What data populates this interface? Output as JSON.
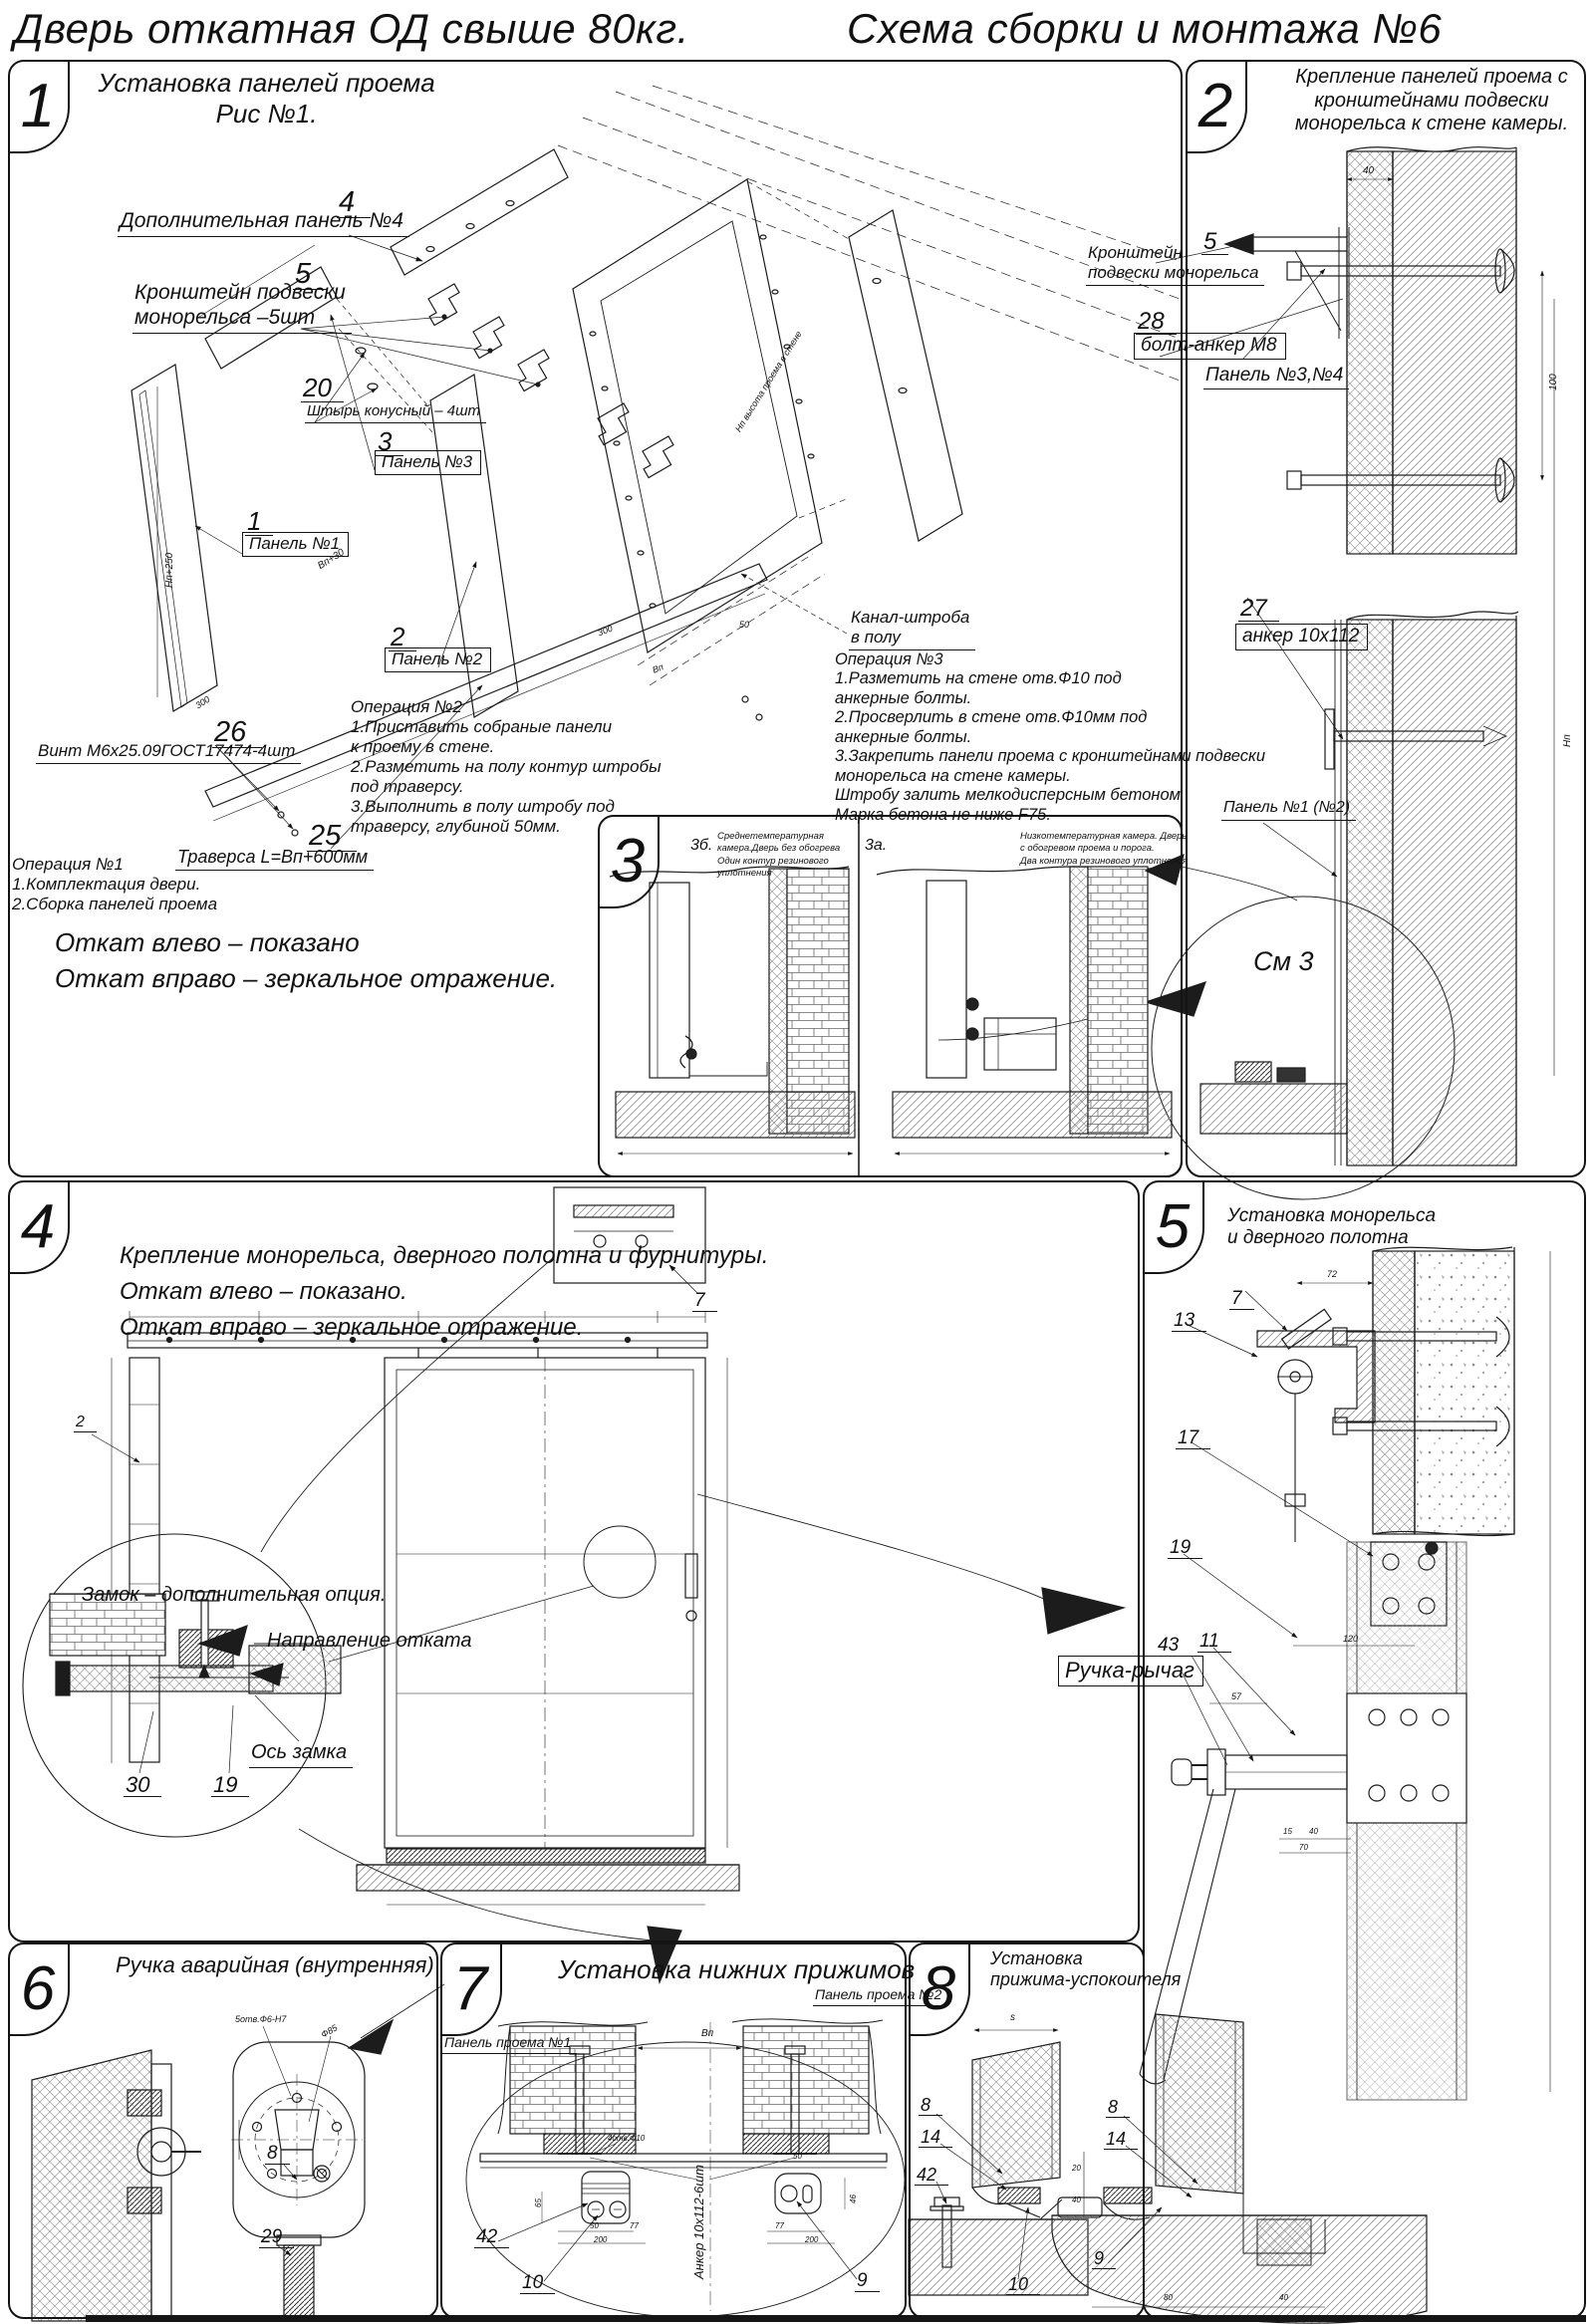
{
  "header": {
    "title_left": "Дверь откатная ОД свыше 80кг.",
    "title_right": "Схема сборки и монтажа №6"
  },
  "p1": {
    "num": "1",
    "title": "Установка панелей проема\nРис №1.",
    "c4n": "4",
    "c4t": "Дополнительная панель №4",
    "c5n": "5",
    "c5t": "Кронштейн подвески\nмонорельса –5шт",
    "c20n": "20",
    "c20t": "Штырь конусный – 4шт",
    "c3n": "3",
    "c3t": "Панель №3",
    "c1n": "1",
    "c1t": "Панель №1",
    "c2n": "2",
    "c2t": "Панель №2",
    "c26n": "26",
    "c26t": "Винт М6х25.09ГОСТ17474-4шт",
    "c25n": "25",
    "c25t": "Траверса  L=Вп+600мм",
    "kanal": "Канал-штроба\nв полу",
    "op1": "Операция №1\n1.Комплектация двери.\n2.Сборка панелей проема",
    "op2": "Операция №2\n1.Приставить собраные панели\nк проему в стене.\n2.Разметить на полу контур штробы\nпод траверсу.\n3.Выполнить в полу штробу под\nтраверсу, глубиной 50мм.",
    "op3": "Операция №3\n1.Разметить на стене отв.Ф10 под\nанкерные болты.\n2.Просверлить в стене отв.Ф10мм  под\nанкерные болты.\n3.Закрепить панели проема с кронштейнами подвески\nмонорельса на стене камеры.\nШтробу залить мелкодисперсным бетоном\nМарка бетона не ниже  F75.",
    "note": "Откат влево – показано\nОткат вправо – зеркальное отражение.",
    "dim_h": "Нп+250",
    "dim_w": "Вп+30",
    "dim300a": "300",
    "dim300b": "300",
    "dim_vp": "Вп",
    "dim50": "50",
    "side_note": "Нп высота проема в стене"
  },
  "p2": {
    "num": "2",
    "title": "Крепление панелей проема с\nкронштейнами  подвески\nмонорельса к стене камеры.",
    "c5n": "5",
    "c5t": "Кронштейн\nподвески монорельса",
    "c28n": "28",
    "c28t": "болт-анкер М8",
    "p34": "Панель №3,№4",
    "c27n": "27",
    "c27t": "анкер 10х112",
    "p12": "Панель №1 (№2)",
    "see3": "См 3",
    "dim40": "40",
    "dim100": "100",
    "dim_np": "Нп"
  },
  "p3": {
    "num": "3",
    "bn": "3б.",
    "bt": "Среднетемпературная камера.Дверь без обогрева\nОдин контур резинового уплотнения",
    "an": "3а.",
    "at": "Низкотемпературная камера. Дверь с обогревом проема и порога.\nДва контура резинового уплотнения"
  },
  "p4": {
    "num": "4",
    "title": "Крепление монорельса, дверного полотна и фурнитуры.\nОткат влево – показано.\nОткат вправо – зеркальное отражение.",
    "c7n": "7",
    "c2n": "2",
    "lock": "Замок – дополнительная опция.",
    "dir": "Направление отката",
    "axis": "Ось замка",
    "c30n": "30",
    "c19n": "19"
  },
  "p5": {
    "num": "5",
    "title": "Установка монорельса\nи дверного полотна",
    "c7n": "7",
    "c13n": "13",
    "c17n": "17",
    "c19n": "19",
    "c43n": "43",
    "c11n": "11",
    "handle": "Ручка-рычаг",
    "dim72": "72",
    "dim120": "120",
    "dim57": "57",
    "dim15": "15",
    "dim40": "40",
    "dim70": "70"
  },
  "p6": {
    "num": "6",
    "title": "Ручка аварийная (внутренняя)",
    "holes": "5отв.Ф6-Н7",
    "dia": "Ф85",
    "c8n": "8",
    "c29n": "29"
  },
  "p7": {
    "num": "7",
    "title": "Установка  нижних  прижимов",
    "pp1": "Панель проема №1",
    "pp2": "Панель проема №2",
    "c42n": "42",
    "c10n": "10",
    "c9n": "9",
    "anchor": "Анкер  10х112-6шт",
    "dim_vp": "Вп",
    "holes": "4отв.Ф10",
    "d65": "65",
    "d50a": "50",
    "d77a": "77",
    "d200a": "200",
    "d50b": "50",
    "d46": "46",
    "d77b": "77",
    "d200b": "200"
  },
  "p8": {
    "num": "8",
    "title": "Установка\nприжима-успокоителя",
    "c8n": "8",
    "c14n": "14",
    "c42n": "42",
    "c10n": "10",
    "dim_s": "s",
    "r8n": "8",
    "r14n": "14",
    "r9n": "9",
    "d20": "20",
    "d40": "40",
    "d80": "80",
    "d40b": "40"
  }
}
